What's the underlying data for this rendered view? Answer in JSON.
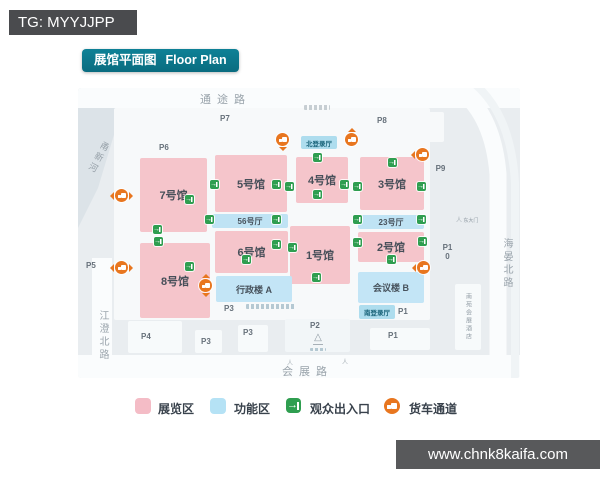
{
  "header": {
    "tag": "TG: MYYJJPP"
  },
  "title": {
    "cn": "展馆平面图",
    "en": "Floor Plan"
  },
  "roads": {
    "top": "通途路",
    "bottom": "会展路",
    "left": "江澄北路",
    "right": "海晏北路",
    "river": "甬新河"
  },
  "map": {
    "halls": {
      "h7": "7号馆",
      "h8": "8号馆",
      "h5": "5号馆",
      "h56": "56号厅",
      "h6": "6号馆",
      "h4": "4号馆",
      "h1": "1号馆",
      "h3": "3号馆",
      "h23": "23号厅",
      "h2": "2号馆"
    },
    "functions": {
      "admin": "行政楼 A",
      "conference": "会议楼 B",
      "north_lobby": "北登录厅",
      "south_lobby": "南登录厅"
    },
    "hotel": "南苑会展酒店",
    "east_gate": "东大门",
    "parking": {
      "p1": "P1",
      "p2": "P2",
      "p3": "P3",
      "p4": "P4",
      "p5": "P5",
      "p6": "P6",
      "p7": "P7",
      "p8": "P8",
      "p9": "P9",
      "p10": "P10"
    }
  },
  "legend": {
    "exhibition": "展览区",
    "function": "功能区",
    "entrance": "观众出入口",
    "truck": "货车通道"
  },
  "footer": {
    "url": "www.chnk8kaifa.com"
  },
  "icons": {
    "entrance": "door-arrow-in-icon",
    "truck": "truck-route-icon",
    "tower": "tower-landmark-icon",
    "person": "pedestrian-icon"
  },
  "colors": {
    "accent_teal": "#0c7689",
    "exhibition_pink": "#f5c5cb",
    "function_blue": "#c3e5f6",
    "entrance_green": "#2f9e50",
    "truck_orange": "#e8761f"
  }
}
